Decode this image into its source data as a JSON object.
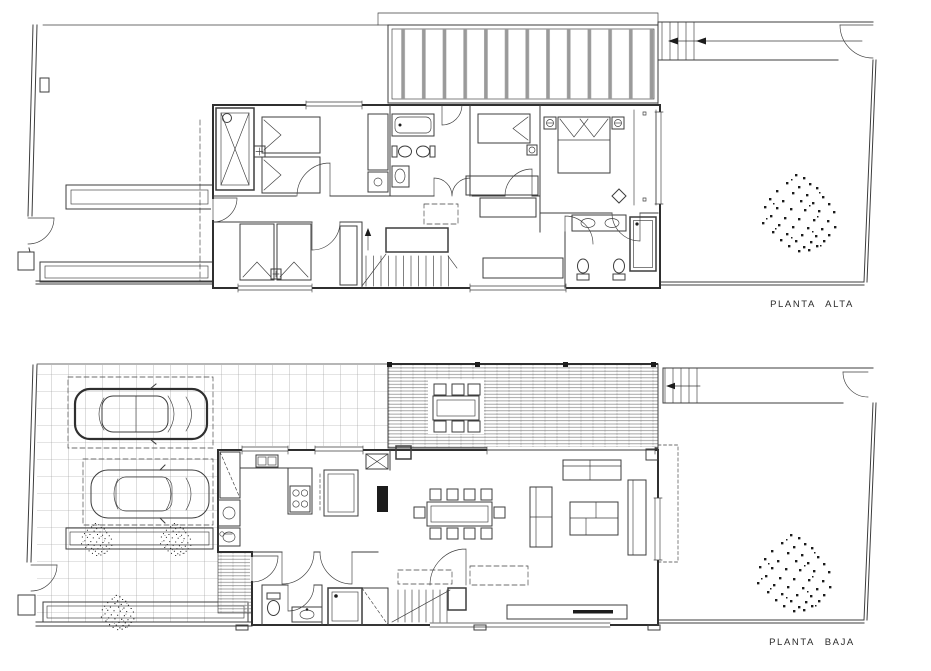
{
  "meta": {
    "width": 931,
    "height": 671,
    "background": "#ffffff"
  },
  "drawing": {
    "type": "architectural floor plan, two storeys of a row house",
    "line_color": "#3d3d3d",
    "grid_color": "#777777",
    "slat_color": "#8f8f8f",
    "pergola_bar_color": "#9a9a9a",
    "dark_fill": "#1c1c1c"
  },
  "plans": {
    "upper": {
      "label": "PLANTA ALTA",
      "features": [
        "pergola-slats",
        "roof-walkway",
        "direction-arrow",
        "walkway-door",
        "elevator-shaft",
        "twin-bedroom",
        "second-twin-bedroom",
        "single-bed-dressing-room",
        "master-bedroom",
        "wardrobes",
        "bathroom-1-bathtub-toilet-bidet-sink",
        "bathroom-2-double-sink-shower-toilet-bidet",
        "staircase-up-arrow",
        "skylight-dashed",
        "side-patio-planters",
        "terrace",
        "tree"
      ]
    },
    "lower": {
      "label": "PLANTA BAJA",
      "features": [
        "tiled-driveway",
        "parking-bay-1",
        "parking-bay-2",
        "car-1",
        "car-2",
        "planter-bushes",
        "entry-steps",
        "entry-door",
        "kitchen-counter-sink-cooktop",
        "fridge",
        "kitchen-island",
        "pantry-laundry",
        "dining-table-10-chairs",
        "living-sofas",
        "coffee-table",
        "tv-console",
        "powder-room",
        "shower",
        "under-stair-storage",
        "staircase",
        "wood-deck",
        "outdoor-dining-table-6-chairs",
        "rear-walkway",
        "garden",
        "tree"
      ]
    }
  }
}
